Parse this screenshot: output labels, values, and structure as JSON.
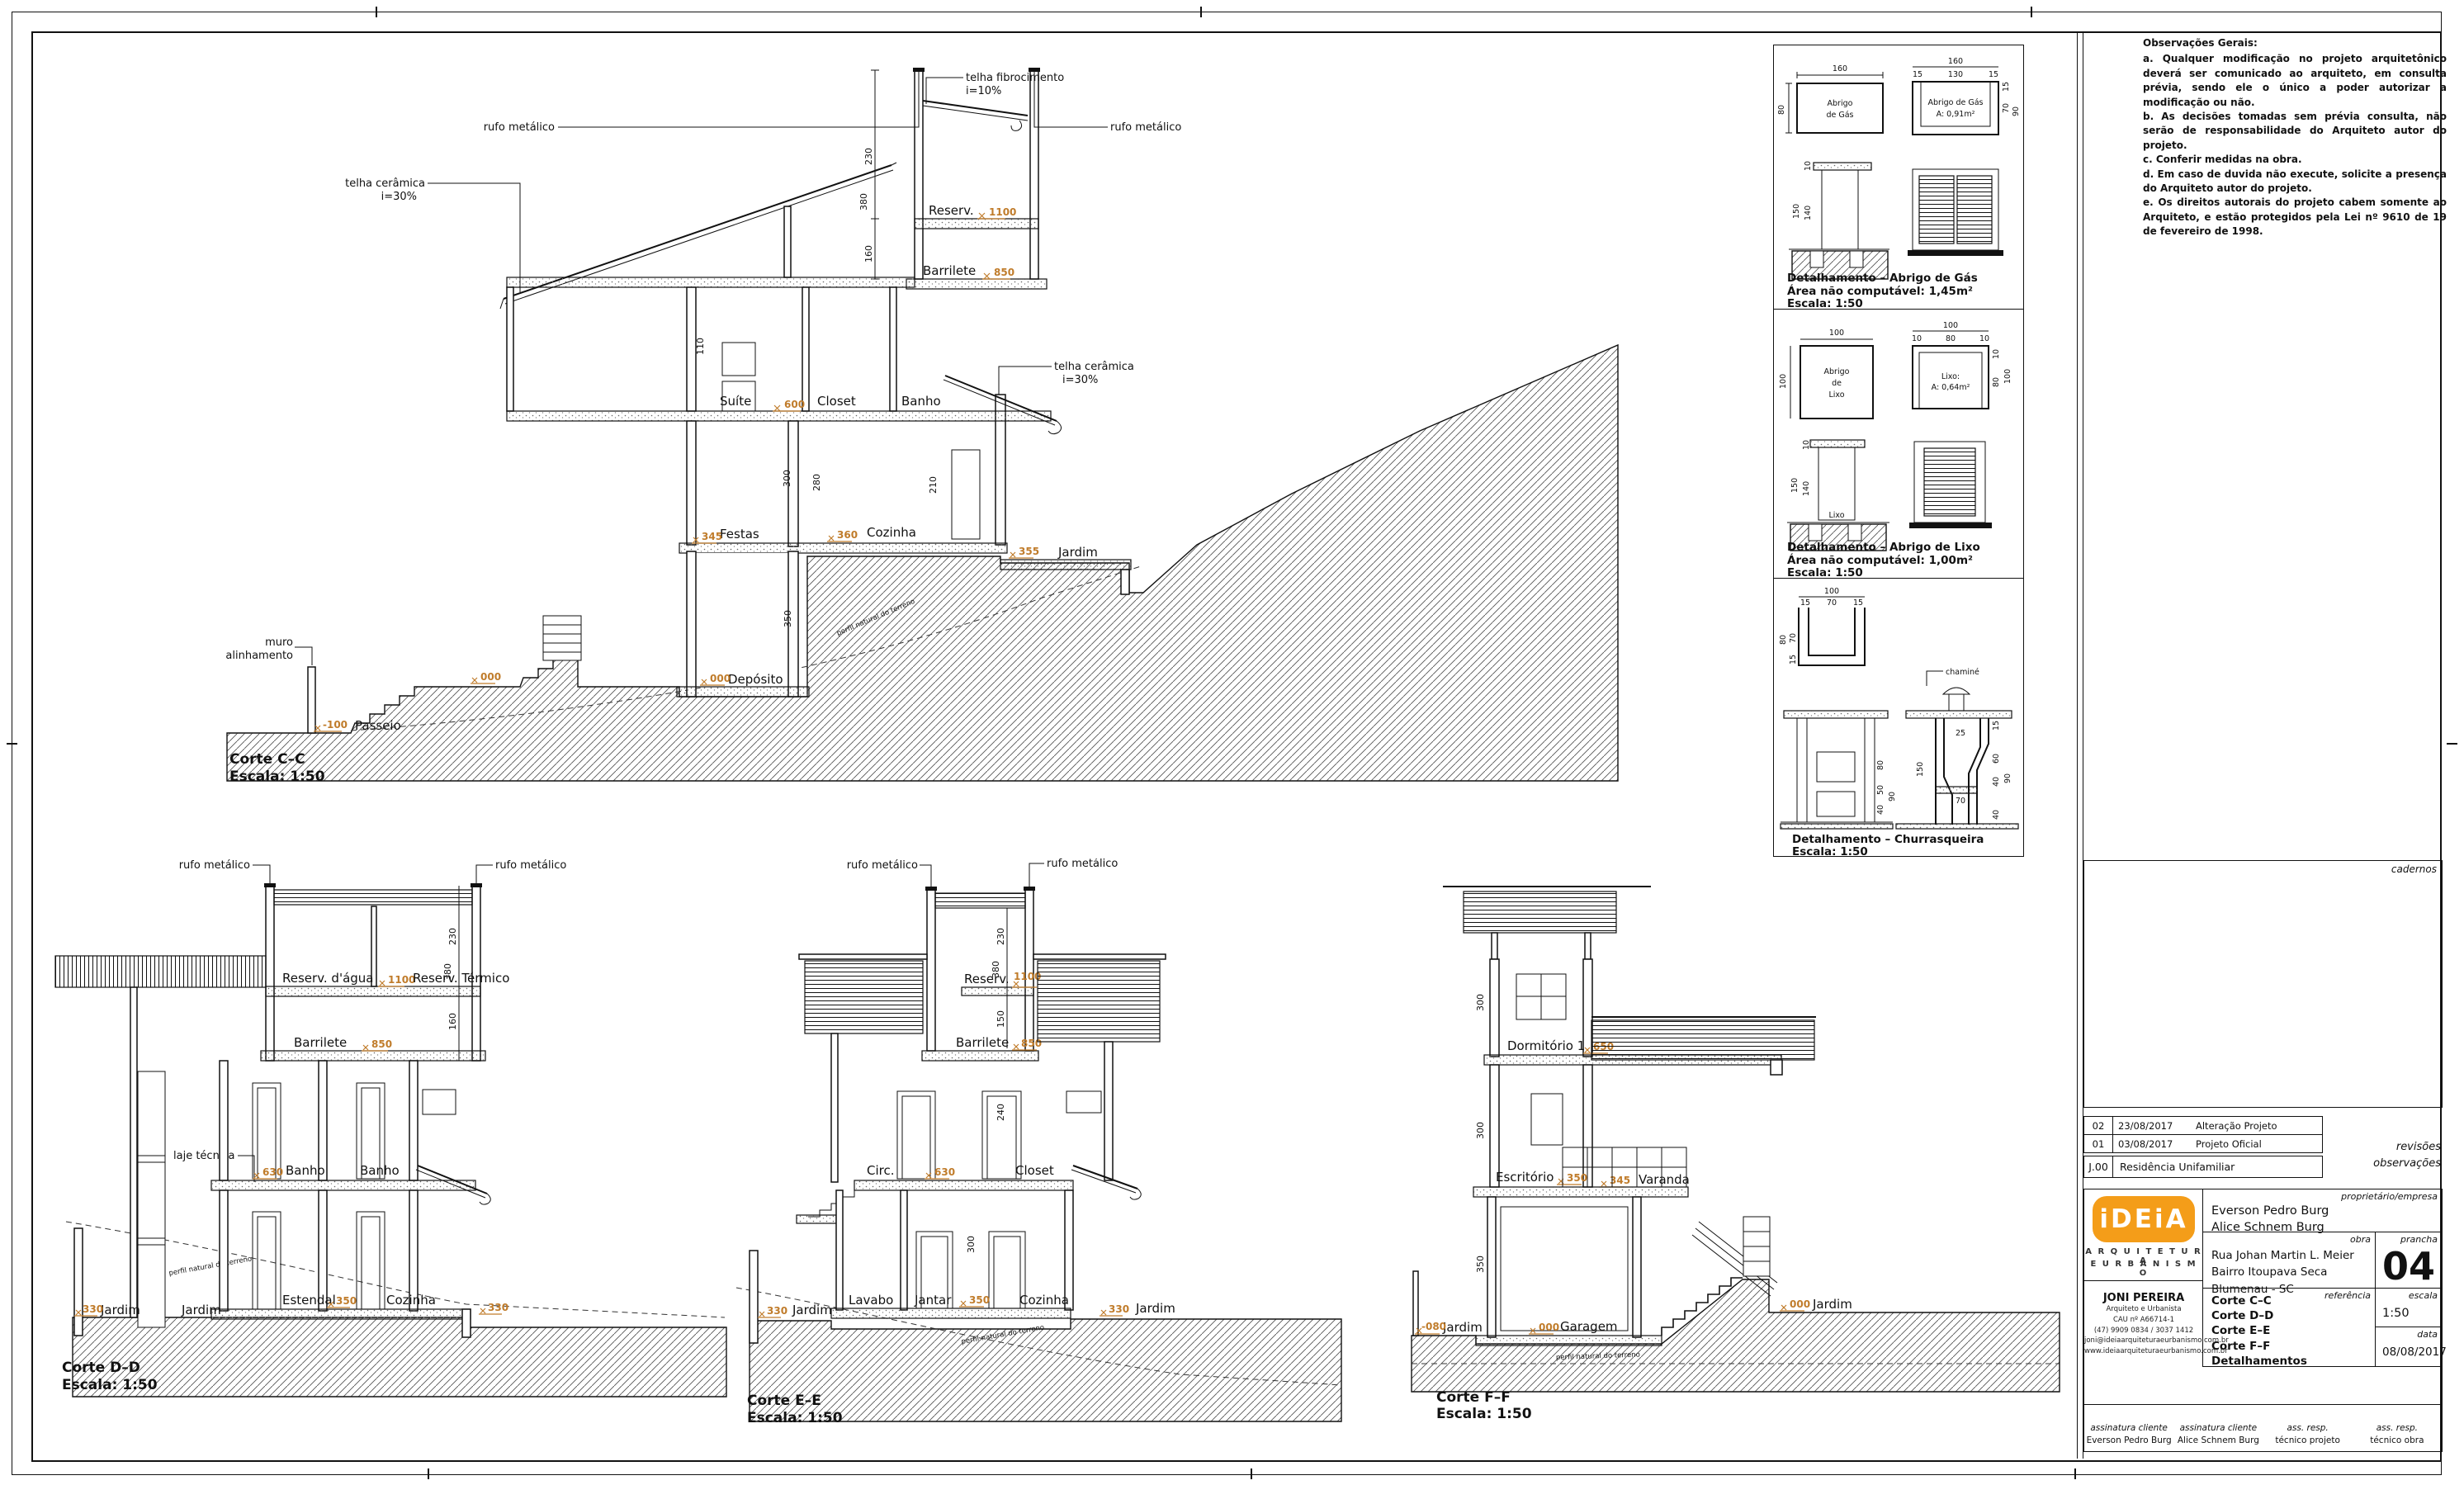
{
  "observations": {
    "title": "Observações Gerais:",
    "items": [
      "a. Qualquer modificação no projeto arquitetônico deverá ser comunicado ao arquiteto, em consulta prévia, sendo ele o único a poder autorizar a modificação ou não.",
      "b. As decisões tomadas sem prévia consulta, não serão de responsabilidade do Arquiteto autor do projeto.",
      "c. Conferir medidas na obra.",
      "d. Em caso de duvida não execute, solicite a presença do Arquiteto autor do projeto.",
      "e. Os direitos autorais do projeto cabem somente ao Arquiteto, e estão protegidos pela Lei nº 9610 de 19 de fevereiro de 1998."
    ]
  },
  "sections": {
    "cc": {
      "title": "Corte C–C",
      "scale": "Escala: 1:50",
      "labels": {
        "telha_fibro_1": "telha fibrocimento",
        "telha_fibro_2": "i=10%",
        "rufo_l": "rufo metálico",
        "rufo_r": "rufo metálico",
        "telha_cer_l1": "telha cerâmica",
        "telha_cer_l2": "i=30%",
        "telha_cer_r1": "telha cerâmica",
        "telha_cer_r2": "i=30%",
        "reserv": "Reserv.",
        "barrilete": "Barrilete",
        "suite": "Suíte",
        "closet": "Closet",
        "banho": "Banho",
        "festas": "Festas",
        "cozinha": "Cozinha",
        "jardim": "Jardim",
        "deposito": "Depósito",
        "passeio": "Passeio",
        "muro_1": "muro",
        "muro_2": "alinhamento",
        "terreno": "perfil natural do terreno"
      },
      "levels": {
        "reserv": "1100",
        "barrilete": "850",
        "suite": "600",
        "festas": "345",
        "cozinha": "360",
        "jardim": "355",
        "deposito": "000",
        "ground": "000",
        "passeio": "-100"
      },
      "dims": {
        "d1": "230",
        "d2": "380",
        "d3": "160",
        "d4": "110",
        "d5": "300",
        "d6": "280",
        "d7": "210",
        "d8": "350"
      }
    },
    "dd": {
      "title": "Corte D–D",
      "scale": "Escala: 1:50",
      "labels": {
        "rufo_l": "rufo metálico",
        "rufo_r": "rufo metálico",
        "reserv_agua": "Reserv. d'água",
        "reserv_term": "Reserv. Térmico",
        "barrilete": "Barrilete",
        "laje": "laje técnica",
        "banho1": "Banho",
        "banho2": "Banho",
        "jardim1": "Jardim",
        "jardim2": "Jardim",
        "estendal": "Estendal",
        "cozinha": "Cozinha",
        "terreno": "perfil natural do terreno"
      },
      "levels": {
        "reserv": "1100",
        "barrilete": "850",
        "banho": "630",
        "jardim": "330",
        "estendal": "350",
        "right": "330"
      },
      "dims": {
        "d1": "230",
        "d2": "380",
        "d3": "160"
      }
    },
    "ee": {
      "title": "Corte E–E",
      "scale": "Escala: 1:50",
      "labels": {
        "rufo_l": "rufo metálico",
        "rufo_r": "rufo metálico",
        "reserv": "Reserv.",
        "barrilete": "Barrilete",
        "circ": "Circ.",
        "closet": "Closet",
        "lavabo": "Lavabo",
        "jantar": "Jantar",
        "cozinha": "Cozinha",
        "jardim_l": "Jardim",
        "jardim_r": "Jardim",
        "terreno": "perfil natural do terreno"
      },
      "levels": {
        "reserv": "1100",
        "barrilete": "850",
        "circ": "630",
        "jantar": "350",
        "jardim_l": "330",
        "jardim_r": "330"
      },
      "dims": {
        "d1": "230",
        "d2": "380",
        "d3": "150",
        "d4": "240",
        "d5": "300"
      }
    },
    "ff": {
      "title": "Corte F–F",
      "scale": "Escala: 1:50",
      "labels": {
        "dormitorio": "Dormitório 1",
        "escritorio": "Escritório",
        "varanda": "Varanda",
        "garagem": "Garagem",
        "jardim_l": "Jardim",
        "jardim_r": "Jardim",
        "terreno": "perfil natural do terreno"
      },
      "levels": {
        "dormitorio": "650",
        "escritorio": "350",
        "varanda": "345",
        "garagem": "000",
        "jardim_l": "-080",
        "jardim_r": "000"
      },
      "dims": {
        "d1": "300",
        "d2": "300",
        "d3": "350"
      }
    }
  },
  "details": {
    "gas": {
      "plan": [
        "Abrigo",
        "de Gás"
      ],
      "section": [
        "Abrigo de Gás",
        "A: 0,91m²"
      ],
      "dims": {
        "plan_w": "160",
        "plan_h": "80",
        "sec_w": "160",
        "sec_s1": "15",
        "sec_in": "130",
        "sec_s2": "15",
        "sec_h": "90",
        "sec_hi": "70",
        "sec_t": "15",
        "h": "150",
        "hi": "140",
        "cap": "10"
      },
      "caption": [
        "Detalhamento – Abrigo de Gás",
        "Área não computável: 1,45m²",
        "Escala: 1:50"
      ]
    },
    "lixo": {
      "plan": [
        "Abrigo",
        "de",
        "Lixo"
      ],
      "section": [
        "Lixo:",
        "A: 0,64m²"
      ],
      "label": "Lixo",
      "dims": {
        "plan_w": "100",
        "plan_h": "100",
        "sec_w": "100",
        "sec_s1": "10",
        "sec_in": "80",
        "sec_s2": "10",
        "sec_h": "80",
        "sec_t": "10",
        "sec_ht": "100",
        "h": "150",
        "hi": "140",
        "cap": "10"
      },
      "caption": [
        "Detalhamento – Abrigo de Lixo",
        "Área não computável: 1,00m²",
        "Escala: 1:50"
      ]
    },
    "churrasqueira": {
      "chamine": "chaminé",
      "dims": {
        "plan_w": "100",
        "plan_s1": "15",
        "plan_in": "70",
        "plan_s2": "15",
        "plan_h": "80",
        "plan_hi": "70",
        "plan_b": "15",
        "e1": "80",
        "e2": "50",
        "e3": "40",
        "e4": "90",
        "s1": "25",
        "s2": "150",
        "s3": "15",
        "s4": "60",
        "s5": "40",
        "s6": "70",
        "s7": "90",
        "s8": "40"
      },
      "caption": [
        "Detalhamento – Churrasqueira",
        "Escala: 1:50"
      ]
    }
  },
  "panel": {
    "cadernos_label": "cadernos",
    "revisions": {
      "label": "revisões",
      "rows": [
        {
          "idx": "02",
          "date": "23/08/2017",
          "desc": "Alteração Projeto"
        },
        {
          "idx": "01",
          "date": "03/08/2017",
          "desc": "Projeto Oficial"
        }
      ]
    },
    "observacoes_label": "observações",
    "project": {
      "code": "J.00",
      "title": "Residência Unifamiliar"
    },
    "titleblock": {
      "logo_text": "iDEiA",
      "logo_sub1": "A R Q U I T E T U R A",
      "logo_sub2": "E  U R B A N I S M O",
      "architect": {
        "name": "JONI PEREIRA",
        "role": "Arquiteto e Urbanista",
        "cau": "CAU nº A66714-1",
        "phone": "(47) 9909 0834 / 3037 1412",
        "email": "joni@ideiaarquiteturaeurbanismo.com.br",
        "site": "www.ideiaarquiteturaeurbanismo.com.br"
      },
      "owner_label": "proprietário/empresa",
      "owners": [
        "Everson Pedro Burg",
        "Alice Schnem Burg"
      ],
      "obra_label": "obra",
      "obra": [
        "Rua Johan Martin L. Meier",
        "Bairro Itoupava Seca",
        "Blumenau - SC"
      ],
      "prancha_label": "prancha",
      "prancha": "04",
      "ref_label": "referência",
      "refs": [
        "Corte C–C",
        "Corte D–D",
        "Corte E–E",
        "Corte F–F",
        "Detalhamentos"
      ],
      "escala_label": "escala",
      "escala": "1:50",
      "data_label": "data",
      "data": "08/08/2017",
      "signatures": [
        {
          "l1": "assinatura cliente",
          "l2": "Everson Pedro Burg"
        },
        {
          "l1": "assinatura cliente",
          "l2": "Alice Schnem Burg"
        },
        {
          "l1": "ass. resp.",
          "l2": "técnico projeto"
        },
        {
          "l1": "ass. resp.",
          "l2": "técnico obra"
        }
      ]
    }
  }
}
